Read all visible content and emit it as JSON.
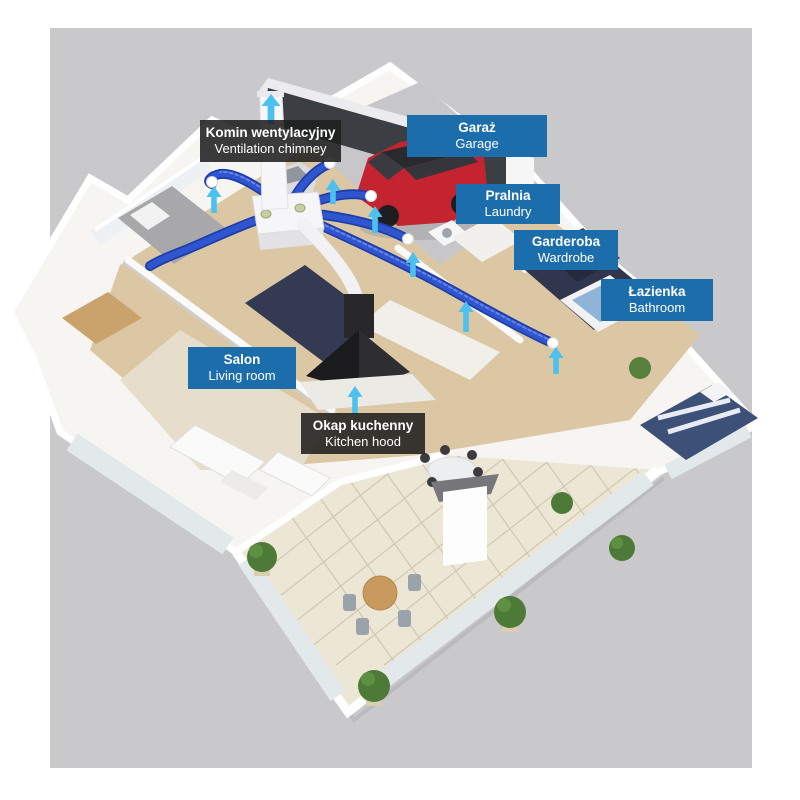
{
  "diagram": {
    "type": "3d-floorplan-ventilation-diagram",
    "language_pair": "Polish / English"
  },
  "labels": {
    "ventilation_chimney": {
      "pl": "Komin wentylacyjny",
      "en": "Ventilation chimney",
      "style": "dark"
    },
    "garage": {
      "pl": "Garaż",
      "en": "Garage",
      "style": "blue"
    },
    "laundry": {
      "pl": "Pralnia",
      "en": "Laundry",
      "style": "blue"
    },
    "wardrobe": {
      "pl": "Garderoba",
      "en": "Wardrobe",
      "style": "blue"
    },
    "bathroom": {
      "pl": "Łazienka",
      "en": "Bathroom",
      "style": "blue"
    },
    "living_room": {
      "pl": "Salon",
      "en": "Living room",
      "style": "blue"
    },
    "kitchen_hood": {
      "pl": "Okap kuchenny",
      "en": "Kitchen hood",
      "style": "dark"
    }
  },
  "icons": {
    "airflow_arrow": "cyan up-arrow showing air flow direction",
    "airflow_arrow_count": 8
  },
  "colors": {
    "label_blue": "#1c6dab",
    "label_dark_bg": "rgba(30,30,30,0.87)",
    "label_text": "#ffffff",
    "duct_blue": "#2f55cf",
    "duct_blue_dark": "#1d3da8",
    "airflow_arrow_cyan": "#4cc0ef",
    "backdrop_gray": "#c9c9cb",
    "car_red": "#c32430",
    "garage_wall_dark": "#3b3e42",
    "bathroom_tile_navy": "#30364e",
    "wood_floor": "#dbc7a3",
    "patio_tile": "#ece6d4"
  }
}
